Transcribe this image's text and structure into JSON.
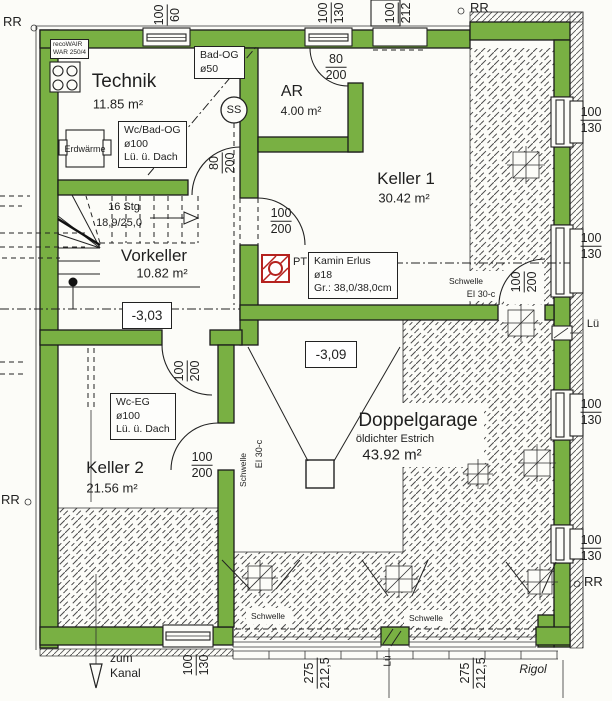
{
  "colors": {
    "wall_green": "#79b043",
    "kamin_red": "#b5221f",
    "paper": "#fcfcf8",
    "ink": "#1f1f1f"
  },
  "rooms": {
    "technik": {
      "name": "Technik",
      "area": "11.85 m²"
    },
    "ar": {
      "name": "AR",
      "area": "4.00 m²"
    },
    "keller1": {
      "name": "Keller 1",
      "area": "30.42 m²"
    },
    "vorkeller": {
      "name": "Vorkeller",
      "area": "10.82 m²"
    },
    "keller2": {
      "name": "Keller 2",
      "area": "21.56 m²"
    },
    "garage": {
      "name": "Doppelgarage",
      "note": "öldichter Estrich",
      "area": "43.92 m²"
    }
  },
  "levels": {
    "vorkeller": "-3,03",
    "garage": "-3,09"
  },
  "stair": {
    "steps": "16 Stg",
    "ratio": "18,9/25,0"
  },
  "boxes": {
    "recovair": {
      "line1": "recoWAIR",
      "line2": "WAR 250/4"
    },
    "bad_og": {
      "line1": "Bad-OG",
      "line2": "ø50"
    },
    "wc_bad_og": {
      "line1": "Wc/Bad-OG",
      "line2": "ø100",
      "line3": "Lü. ü. Dach"
    },
    "wc_eg": {
      "line1": "Wc-EG",
      "line2": "ø100",
      "line3": "Lü. ü. Dach"
    },
    "kamin": {
      "line1": "Kamin Erlus",
      "line2": "ø18",
      "line3": "Gr.: 38,0/38,0cm"
    },
    "erdwaerme": "Erdwärme",
    "ss": "SS",
    "pt": "PT"
  },
  "dims": {
    "w100_60": [
      "100",
      "60"
    ],
    "w100_130": [
      "100",
      "130"
    ],
    "d100_212": [
      "100",
      "212"
    ],
    "d80_200": [
      "80",
      "200"
    ],
    "d100_200": [
      "100",
      "200"
    ],
    "d275": [
      "275",
      "212,5"
    ]
  },
  "labels": {
    "rr": "RR",
    "lue": "Lü",
    "schwelle": "Schwelle",
    "ei30": "EI 30-c",
    "rigol": "Rigol",
    "zum": "zum",
    "kanal": "Kanal"
  }
}
